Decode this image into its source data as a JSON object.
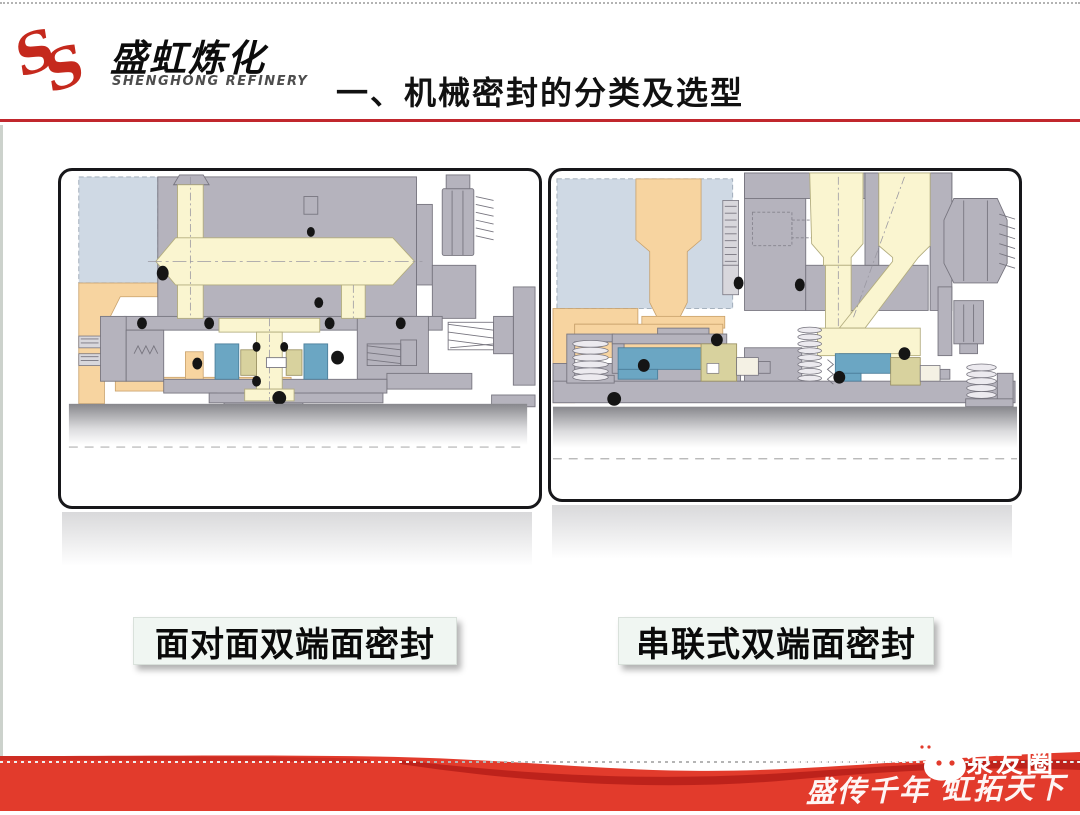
{
  "header": {
    "logo_cn": "盛虹炼化",
    "logo_en": "SHENGHONG REFINERY",
    "title": "一、机械密封的分类及选型"
  },
  "figures": [
    {
      "caption": "面对面双端面密封"
    },
    {
      "caption": "串联式双端面密封"
    }
  ],
  "footer": {
    "wechat_account": "泵友圈",
    "slogan": "盛传千年 虹拓天下"
  },
  "palette": {
    "brand": "#c5291d",
    "rule": "#c1272d",
    "band": "#e23b2c",
    "band_dark": "#b9201a",
    "metal": "#b5b3bd",
    "cream": "#faf5d0",
    "blue": "#6ba6c3",
    "olive": "#d8d29e",
    "orange": "#f7d4a0",
    "lightblue": "#cfd9e4",
    "label_bg": "#f0f6f2"
  }
}
